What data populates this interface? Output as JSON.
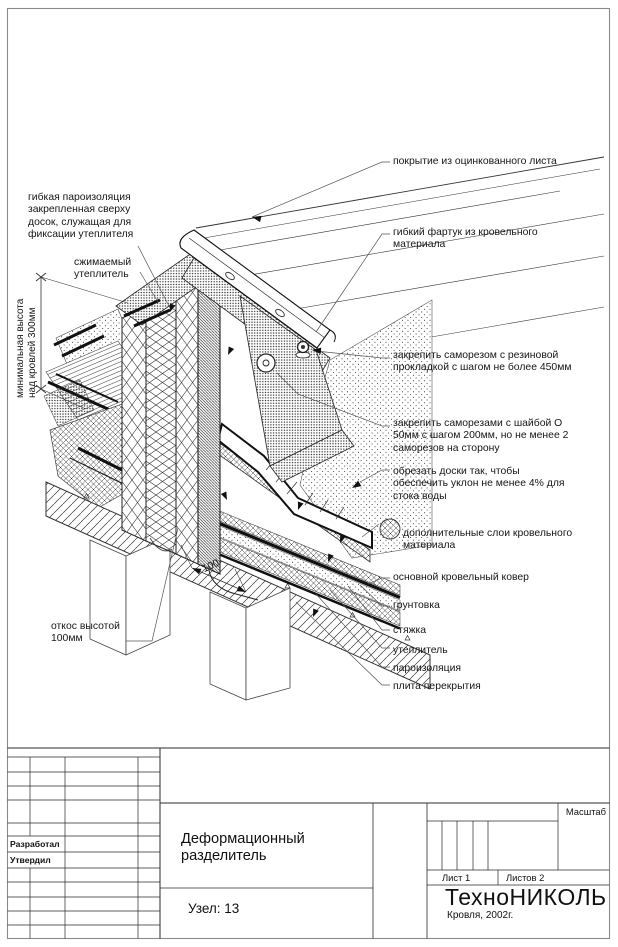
{
  "drawing": {
    "kind": "roofing detail, isometric CAD drawing",
    "labels_left": [
      {
        "id": "flexible-vapor-barrier",
        "text": "гибкая пароизоляция\nзакрепленная сверху\nдосок, служащая для\nфиксации утеплителя"
      },
      {
        "id": "compressible-insulation",
        "text": "сжимаемый\nутеплитель"
      },
      {
        "id": "min-height",
        "text": "минимальная высота\nнад кровлей 300мм"
      },
      {
        "id": "slope-100",
        "text": "откос высотой\n100мм"
      }
    ],
    "labels_right": [
      {
        "id": "galvanized-cover",
        "text": "покрытие из оцинкованного листа"
      },
      {
        "id": "flexible-apron",
        "text": "гибкий фартук из кровельного\nматериала"
      },
      {
        "id": "screw-rubber",
        "text": "закрепить саморезом с резиновой\nпрокладкой с шагом не более 450мм"
      },
      {
        "id": "screw-washer",
        "text": "закрепить саморезами с шайбой О\n50мм с шагом 200мм, но не менее 2\nсаморезов на сторону"
      },
      {
        "id": "cut-boards",
        "text": "обрезать доски так, чтобы\nобеспечить уклон не менее 4% для\nстока воды"
      },
      {
        "id": "extra-layers",
        "text": "дополнительные слои кровельного\nматериала"
      },
      {
        "id": "main-carpet",
        "text": "основной кровельный ковер"
      },
      {
        "id": "primer",
        "text": "грунтовка"
      },
      {
        "id": "screed",
        "text": "стяжка"
      },
      {
        "id": "insulation",
        "text": "утеплитель"
      },
      {
        "id": "vapor-barrier",
        "text": "пароизоляция"
      },
      {
        "id": "floor-slab",
        "text": "плита перекрытия"
      }
    ],
    "dimensions": {
      "upstand_width": "100"
    }
  },
  "title_block": {
    "developed_label": "Разработал",
    "approved_label": "Утвердил",
    "drawing_title": "Деформационный\nразделитель",
    "node_label": "Узел: 13",
    "scale_label": "Масштаб",
    "sheet_label": "Лист 1",
    "sheets_label": "Листов 2",
    "company": "ТехноНИКОЛЬ",
    "company_sub": "Кровля, 2002г."
  },
  "colors": {
    "line": "#2b2b2b",
    "border": "#8a8a8a",
    "background": "#ffffff"
  }
}
